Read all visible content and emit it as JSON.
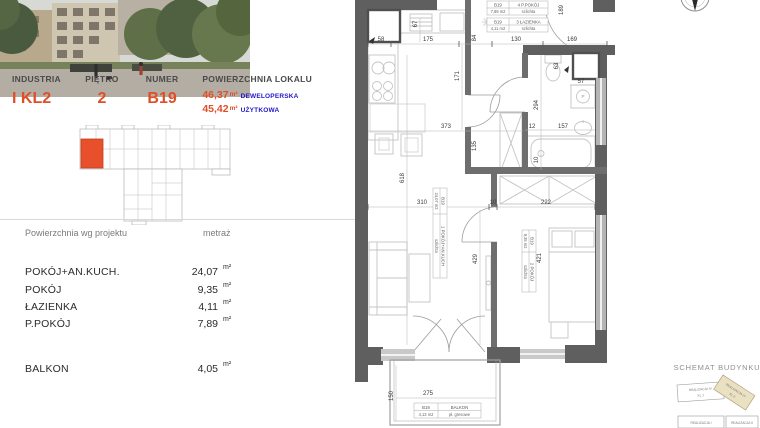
{
  "header": {
    "columns": [
      {
        "label": "INDUSTRIA",
        "value": "I KL2"
      },
      {
        "label": "PIĘTRO",
        "value": "2"
      },
      {
        "label": "NUMER",
        "value": "B19"
      }
    ],
    "area_label": "POWIERZCHNIA LOKALU",
    "areas": [
      {
        "value": "46,37",
        "unit": "m²",
        "type": "DEWELOPERSKA"
      },
      {
        "value": "45,42",
        "unit": "m²",
        "type": "UŻYTKOWA"
      }
    ]
  },
  "room_table": {
    "col_left": "Powierzchnia wg projektu",
    "col_right": "metraż",
    "rows": [
      {
        "name": "POKÓJ+AN.KUCH.",
        "value": "24,07",
        "unit": "m²"
      },
      {
        "name": "POKÓJ",
        "value": "9,35",
        "unit": "m²"
      },
      {
        "name": "ŁAZIENKA",
        "value": "4,11",
        "unit": "m²"
      },
      {
        "name": "P.POKÓJ",
        "value": "7,89",
        "unit": "m²"
      }
    ],
    "balcony_row": {
      "name": "BALKON",
      "value": "4,05",
      "unit": "m²"
    }
  },
  "floor_plan": {
    "labels": {
      "ppokoj": {
        "unit": "B19",
        "name": "4 P.POKÓJ",
        "area": "7,89 m2",
        "finish": "szlichta"
      },
      "lazienka": {
        "unit": "B19",
        "name": "3 ŁAZIENKA",
        "area": "4,11 m2",
        "finish": "szlichta"
      },
      "salon": {
        "unit": "B19",
        "name": "1 POKÓJ+AN.KUCH",
        "area": "24,07 m2",
        "finish": "szlichta"
      },
      "pokoj": {
        "unit": "B19",
        "name": "2 POKÓJ",
        "area": "9,35 m2",
        "finish": "szlichta"
      },
      "balkon": {
        "unit": "B19",
        "name": "BALKON",
        "area": "4,13 m2",
        "finish": "pł. gresowe"
      }
    },
    "dims": {
      "top_58": "58",
      "top_175": "175",
      "top_84": "84",
      "top_130": "130",
      "top_169": "169",
      "right_189": "189",
      "kitchen_67": "67",
      "hall_171": "171",
      "living_373": "373",
      "living_135": "135",
      "living_618": "618",
      "mid_310": "310",
      "mid_10": "10",
      "mid_222": "222",
      "bath_294": "294",
      "bath_57": "57",
      "bath_63": "63",
      "bath_12": "12",
      "bath_157": "157",
      "bath_10": "10",
      "living_429": "429",
      "bedroom_421": "421",
      "balcony_150": "150",
      "balcony_275": "275"
    },
    "washer_symbol": "P"
  },
  "schemat": {
    "title": "SCHEMAT BUDYNKU",
    "block1_line1": "REALIZACJA IV",
    "block1_line2": "KL 1",
    "block2_line1": "REALIZACJA IV",
    "block2_line2": "KL 2",
    "block3": "REALIZACJA I",
    "block4": "REALIZACJA II"
  },
  "colors": {
    "accent_orange": "#E04E28",
    "label_blue": "#2018C8",
    "wall_gray": "#5F5F5F",
    "furniture_gray": "#C4C4C4",
    "highlight_beige": "#EAE0C2"
  }
}
